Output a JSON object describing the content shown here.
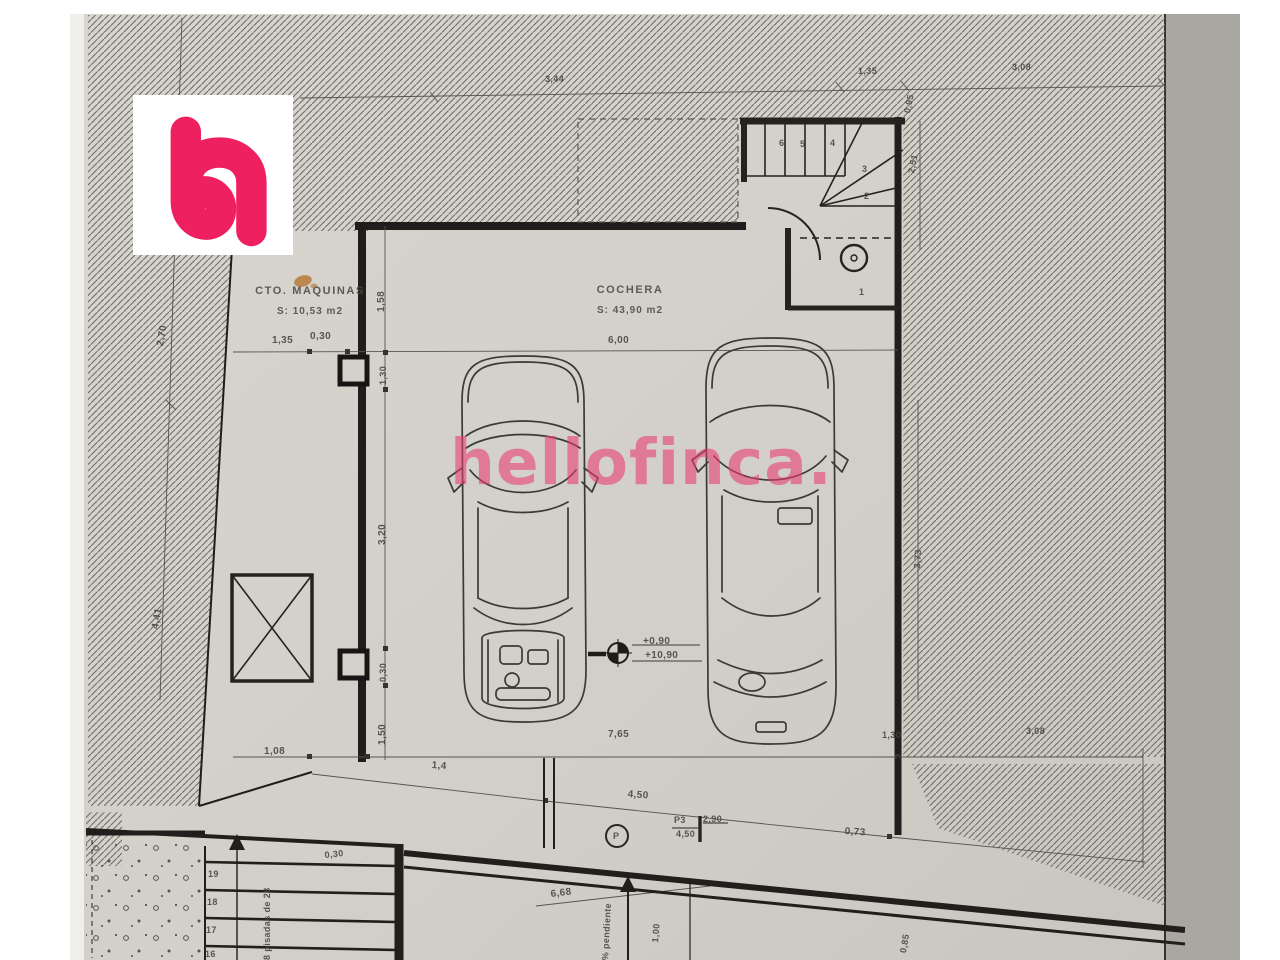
{
  "brand": {
    "watermark": "hellofinca.",
    "logo_letter": "h",
    "accent_color": "#ee2060"
  },
  "rooms": {
    "machine_room": {
      "name": "CTO. MAQUINAS",
      "area": "S: 10,53 m2"
    },
    "garage": {
      "name": "COCHERA",
      "area": "S: 43,90 m2"
    }
  },
  "level_marker": {
    "upper": "+0,90",
    "lower": "+10,90"
  },
  "door": {
    "tag": "P3",
    "width": "2,90",
    "height": "4,50",
    "plug": "P"
  },
  "notes": {
    "treads": "8 pisadas de 28",
    "slope": "% pendiente"
  },
  "dims": {
    "top_a": "3,44",
    "top_b": "1,35",
    "top_c": "3,08",
    "right_a": "0,95",
    "right_b": "2,51",
    "right_c": "3,73",
    "left_a": "2,70",
    "left_b": "4,41",
    "chain_a": "1,58",
    "chain_b": "1,30",
    "chain_c": "3,20",
    "chain_d": "0,30",
    "chain_e": "1,50",
    "front_a": "1,35",
    "front_b": "0,30",
    "front_c": "6,00",
    "bottom_a": "1,08",
    "bottom_b": "1,4",
    "bottom_c": "7,65",
    "bottom_d": "1,30",
    "bottom_e": "3,08",
    "ramp_a": "4,50",
    "ramp_b": "0,73",
    "ramp_c": "6,68",
    "ramp_d": "1,00",
    "ramp_e": "0,30",
    "ramp_f": "0,85"
  },
  "stairs_upper": [
    "6",
    "5",
    "4",
    "3",
    "2",
    "1"
  ],
  "stairs_lower": [
    "19",
    "18",
    "17",
    "16"
  ],
  "colors": {
    "paper": "#d2cfc8",
    "hatch_line": "#6e6c67"
  }
}
